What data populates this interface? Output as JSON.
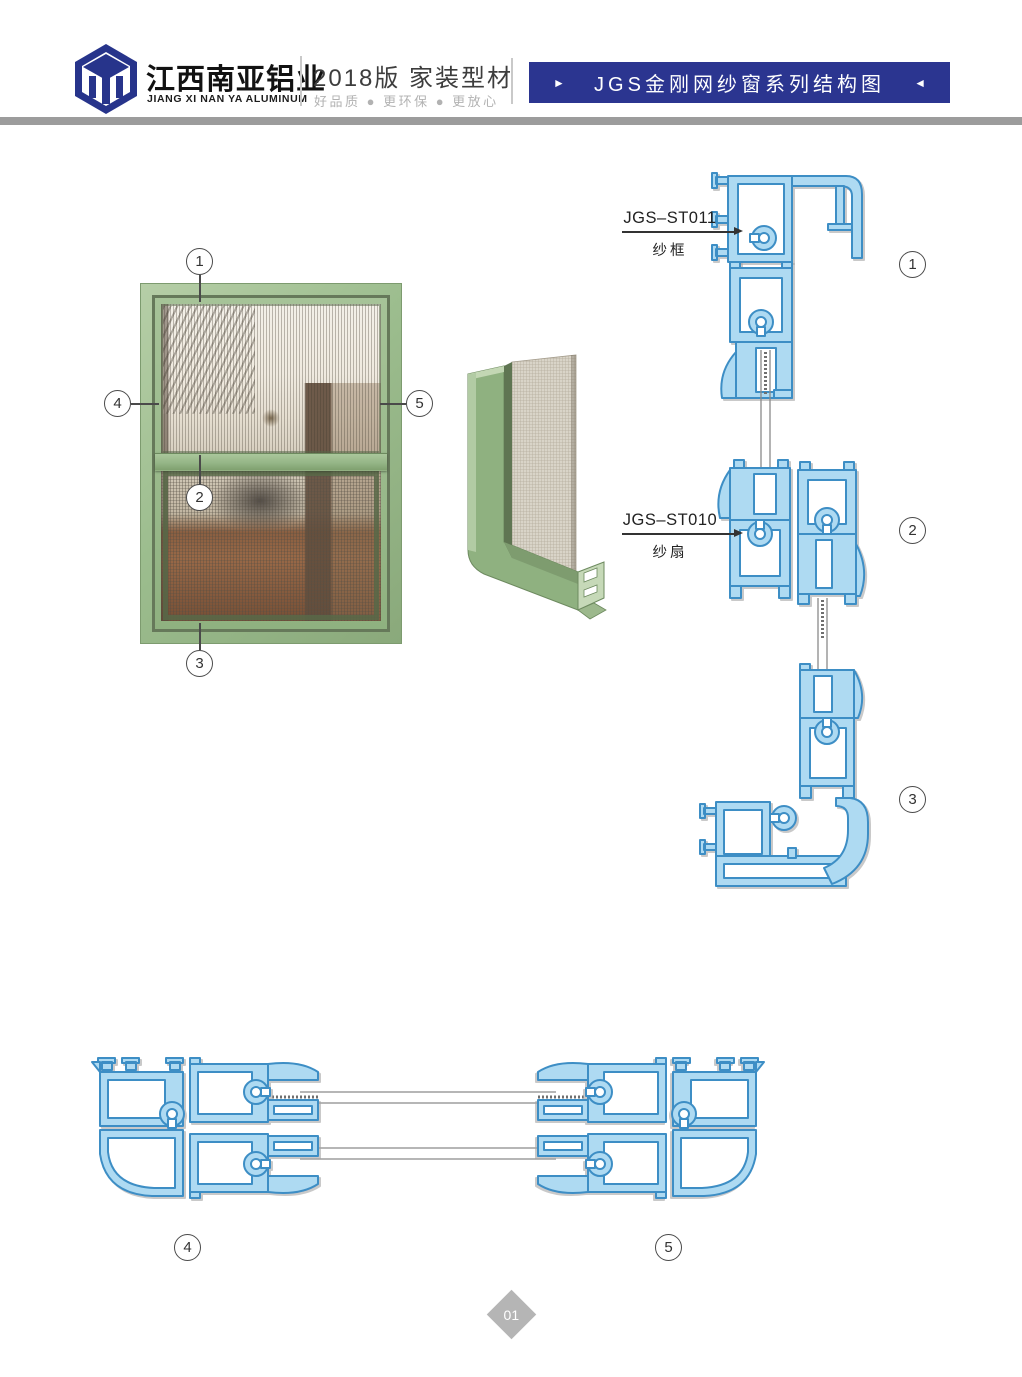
{
  "header": {
    "brand_cn": "江西南亚铝业",
    "brand_en": "JIANG XI NAN YA ALUMINUM",
    "edition": "2018版  家装型材",
    "tagline": "好品质 ● 更环保 ● 更放心",
    "banner_title": "JGS金刚网纱窗系列结构图",
    "banner_arrow_left": "►",
    "banner_arrow_right": "◄"
  },
  "diagram": {
    "profile_labels": [
      {
        "code": "JGS–ST011",
        "name": "纱框"
      },
      {
        "code": "JGS–ST010",
        "name": "纱扇"
      }
    ],
    "window_callouts": {
      "top": "1",
      "middle": "2",
      "bottom": "3",
      "left": "4",
      "right": "5"
    },
    "section_markers_vertical": {
      "v1": "1",
      "v2": "2",
      "v3": "3"
    },
    "section_markers_horizontal": {
      "h4": "4",
      "h5": "5"
    }
  },
  "colors": {
    "brand_blue": "#27348B",
    "banner_blue": "#2B3590",
    "profile_fill": "#AEDAF2",
    "profile_stroke": "#3E8EC5",
    "frame_green": "#9CBD8E"
  },
  "footer": {
    "page_number": "01"
  }
}
